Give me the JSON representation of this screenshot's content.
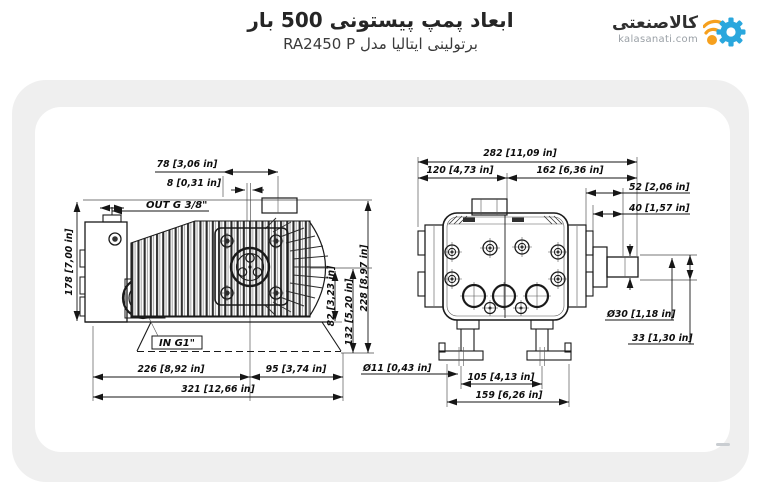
{
  "header": {
    "title": "ابعاد پمپ پیستونی 500 بار",
    "subtitle": "برتولینی ایتالیا مدل RA2450 P"
  },
  "logo": {
    "brand_fa": "کالاصنعتی",
    "brand_domain": "kalasanati.com",
    "gear_color": "#2aa7dd",
    "accent_color": "#f6a01d"
  },
  "diagram": {
    "side_view": {
      "ports": {
        "outlet": "OUT G 3/8\"",
        "inlet": "IN G1\""
      },
      "dimensions": {
        "flange_offset": "78 [3,06 in]",
        "fin_pitch": "8 [0,31 in]",
        "body_height": "178 [7,00 in]",
        "shaft_to_foot": "82 [3,23 in]",
        "shaft_to_base": "132 [5,20 in]",
        "total_height": "228 [8,97 in]",
        "head_length": "226 [8,92 in]",
        "rear_length": "95 [3,74 in]",
        "total_length": "321 [12,66 in]"
      }
    },
    "front_view": {
      "dimensions": {
        "total_width": "282 [11,09 in]",
        "left_width": "120 [4,73 in]",
        "right_width": "162 [6,36 in]",
        "shaft_length": "52 [2,06 in]",
        "shaft_step": "40 [1,57 in]",
        "shaft_diameter": "Ø30 [1,18 in]",
        "shaft_key_height": "33 [1,30 in]",
        "foot_hole_diameter": "Ø11 [0,43 in]",
        "foot_hole_spacing": "105 [4,13 in]",
        "foot_span": "159 [6,26 in]"
      }
    }
  }
}
